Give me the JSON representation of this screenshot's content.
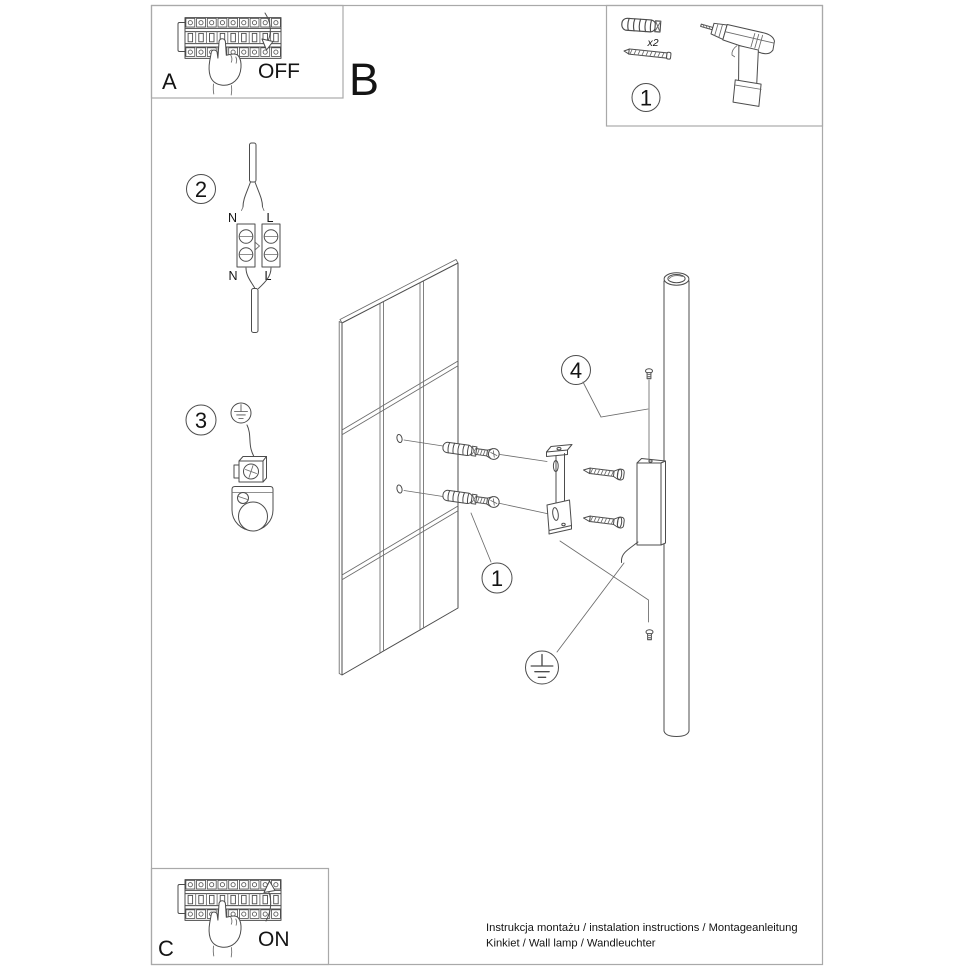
{
  "panel_a": {
    "label": "A",
    "action": "OFF"
  },
  "section_b": {
    "label": "B"
  },
  "panel_c": {
    "label": "C",
    "action": "ON"
  },
  "parts_panel": {
    "step": "1",
    "quantity": "x2"
  },
  "callouts": {
    "step1": "1",
    "step2": "2",
    "step3": "3",
    "step4": "4"
  },
  "wiring": {
    "neutral": "N",
    "live": "L"
  },
  "footer": {
    "line1": "Instrukcja montażu / instalation instructions / Montageanleitung",
    "line2": "Kinkiet / Wall lamp / Wandleuchter"
  },
  "colors": {
    "background": "#ffffff",
    "line_art": "#4c4c4c",
    "panel_border": "#a9a9a9",
    "text": "#141414"
  }
}
